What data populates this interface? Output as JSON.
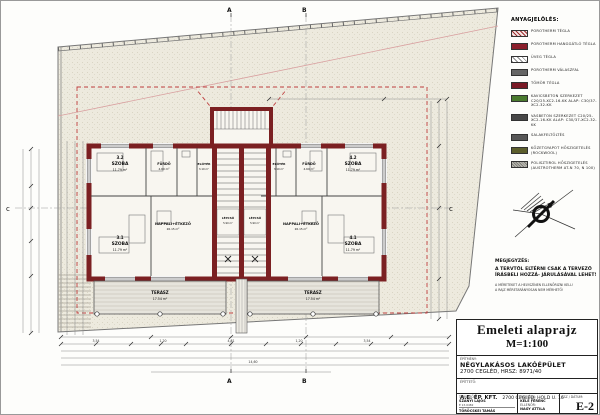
{
  "legend": {
    "title": "ANYAGJELÖLÉS:",
    "items": [
      {
        "label": "POROTHERM TÉGLA",
        "color": "#f3e4e4"
      },
      {
        "label": "POROTHERM HANGGÁTLÓ TÉGLA",
        "color": "#8b1f2c"
      },
      {
        "label": "ÜVEG TÉGLA",
        "color": "#ffffff"
      },
      {
        "label": "POROTHERM VÁLASZFAL",
        "color": "#666666"
      },
      {
        "label": "TÖMÖR TÉGLA",
        "color": "#7a1a26"
      },
      {
        "label": "KAVICSBETON SZERKEZET C20/25-XC2-16-KK ALAP: C30/37-XC2-32-KK",
        "color": "#4a7a2e"
      },
      {
        "label": "VASBETON SZERKEZET C20/25-XC2-16-KK ALAP: C30/37-XC2-32-KK",
        "color": "#474747"
      },
      {
        "label": "SALAKFELTÖLTÉS",
        "color": "#565656"
      },
      {
        "label": "KŐZETGYAPOT HŐSZIGETELÉS (ROCKWOOL)",
        "color": "#5c5e2c"
      },
      {
        "label": "POLISZTIROL HŐSZIGETELÉS (AUSTROTHERM AT-N 70, N 100)",
        "color": "#9b9a92"
      }
    ]
  },
  "notes": {
    "title": "MEGJEGYZÉS:",
    "body": "A TERVTŐL ELTÉRNI CSAK A TERVEZŐ ÍRÁSBELI HOZZÁ- JÁRULÁSÁVAL LEHET!",
    "small1": "A MÉRETEKET A HELYSZÍNEN ELLENŐRIZNI KELL!",
    "small2": "A RAJZ MÉRETARÁNYOSAN NEM MÉRHETŐ!"
  },
  "titleblock": {
    "title": "Emeleti alaprajz",
    "scale": "M=1:100",
    "project_label": "ÉPÍTMÉNY:",
    "project_name": "NÉGYLAKÁSOS LAKÓÉPÜLET",
    "project_addr": "2700 CEGLÉD, HRSZ: 8971/40",
    "client_label": "ÉPÍTTETŐ:",
    "client_name": "A.E. ÉP. KFT.",
    "client_addr": "2700 CEGLÉD, HOLD U. 16",
    "designers_label": "TERVEZŐK:",
    "designer1": "SZANYI LAJOS",
    "designer1_reg": "É 13-0482",
    "designer2": "TÖRÖCSKEI TAMÁS",
    "designer2_reg": "ÉT 13-0519",
    "drawn_label": "RAJZOLTA:",
    "drawn_name": "KELE FERENC",
    "checked_label": "ELLENŐR:",
    "checked_name": "NAGY ATTILA",
    "sheetno_label": "TSZ / DÁTUM:",
    "sheet_no": "E-2"
  },
  "plan": {
    "markers": {
      "top_a": "A",
      "top_b": "B",
      "bottom_a": "A",
      "bottom_b": "B",
      "left_c": "c",
      "right_c": "c"
    },
    "colors": {
      "wall": "#7b2022",
      "dashed_outline": "#c04040",
      "site_fill": "#edeade"
    },
    "rooms": [
      {
        "num": "3.2",
        "name": "SZOBA",
        "area": "11.79 m²"
      },
      {
        "num": "",
        "name": "FÜRDŐ",
        "area": "4.60 m²"
      },
      {
        "num": "",
        "name": "ELŐTÉR",
        "area": "3.10 m²"
      },
      {
        "num": "3.1",
        "name": "SZOBA",
        "area": "11.79 m²"
      },
      {
        "num": "",
        "name": "NAPPALI+ÉTKEZŐ",
        "area": "26.15 m²"
      },
      {
        "num": "",
        "name": "LÉPCSŐ",
        "area": "5.90 m²"
      },
      {
        "num": "",
        "name": "LÉPCSŐ",
        "area": "5.90 m²"
      },
      {
        "num": "",
        "name": "ELŐTÉR",
        "area": "3.10 m²"
      },
      {
        "num": "",
        "name": "FÜRDŐ",
        "area": "4.60 m²"
      },
      {
        "num": "4.2",
        "name": "SZOBA",
        "area": "11.79 m²"
      },
      {
        "num": "4.1",
        "name": "SZOBA",
        "area": "11.79 m²"
      },
      {
        "num": "",
        "name": "NAPPALI+ÉTKEZŐ",
        "area": "26.15 m²"
      },
      {
        "num": "",
        "name": "TERASZ",
        "area": "17.54 m²"
      },
      {
        "num": "",
        "name": "TERASZ",
        "area": "17.54 m²"
      }
    ],
    "dims": [
      "3,54",
      "1,20",
      "4,81",
      "1,20",
      "3,54",
      "14,60"
    ]
  }
}
